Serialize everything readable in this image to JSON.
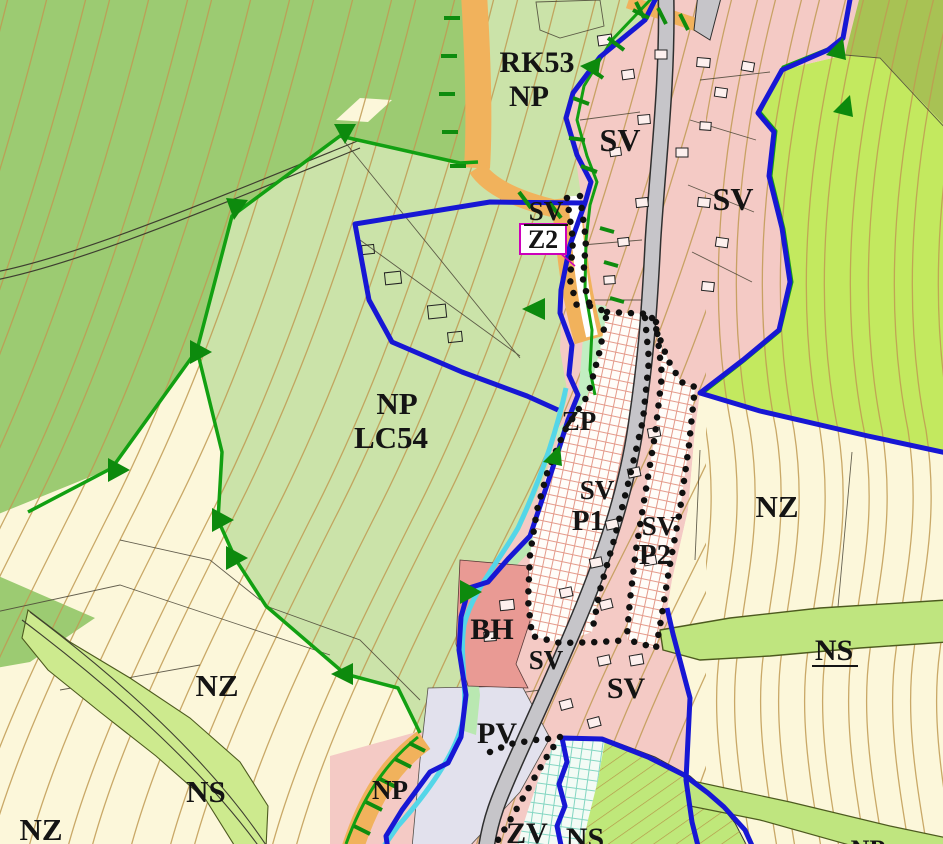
{
  "map": {
    "kind": "municipal zoning plan map section",
    "labels": [
      {
        "text": "RK53",
        "color": "#141414"
      },
      {
        "text": "NP",
        "color": "#141414"
      },
      {
        "text": "SV",
        "color": "#141414"
      },
      {
        "text": "SV",
        "color": "#141414"
      },
      {
        "text": "SV",
        "color": "#141414",
        "underline": true
      },
      {
        "text": "Z2",
        "color": "#cc00bb"
      },
      {
        "text": "NP",
        "color": "#141414"
      },
      {
        "text": "LC54",
        "color": "#141414"
      },
      {
        "text": "ZP",
        "color": "#141414"
      },
      {
        "text": "SV",
        "color": "#141414"
      },
      {
        "text": "P1",
        "color": "#2323cc"
      },
      {
        "text": "SV",
        "color": "#141414"
      },
      {
        "text": "P2",
        "color": "#2323cc"
      },
      {
        "text": "NZ",
        "color": "#141414"
      },
      {
        "text": "NS",
        "color": "#141414",
        "underline": true
      },
      {
        "text": "BH",
        "color": "#141414"
      },
      {
        "text": "SV",
        "color": "#141414"
      },
      {
        "text": "SV",
        "color": "#141414"
      },
      {
        "text": "PV",
        "color": "#141414"
      },
      {
        "text": "NZ",
        "color": "#141414"
      },
      {
        "text": "NS",
        "color": "#141414"
      },
      {
        "text": "NZ",
        "color": "#141414"
      },
      {
        "text": "NP",
        "color": "#141414"
      },
      {
        "text": "ZV",
        "color": "#141414"
      },
      {
        "text": "NS",
        "color": "#141414"
      },
      {
        "text": "NP",
        "color": "#141414"
      }
    ],
    "zone_colors": {
      "forest_medium_green": "#9ccb72",
      "meadow_pale_green": "#cbe3a9",
      "meadow_bright_green": "#c3e95f",
      "olive_green": "#a8c254",
      "arable_cream": "#fcf7da",
      "residential_pink": "#f4cac5",
      "housing_red_BH": "#e99a94",
      "public_space_lavender_PV": "#e2e1ed",
      "greenery_mint_ZP": "#bfe9b5",
      "ns_band_green": "#bfe57f",
      "road_grey": "#c6c5c9"
    },
    "line_colors": {
      "municipal_boundary_blue": "#1717d4",
      "forest_edge_green": "#12a012",
      "path_corridor_orange": "#f1b25c",
      "stream_cyan": "#54d6e8",
      "contour_tan": "#c09a52",
      "development_area_dots": "#101010",
      "annotation_magenta": "#cc00bb",
      "proposal_label_blue": "#2323cc"
    }
  }
}
